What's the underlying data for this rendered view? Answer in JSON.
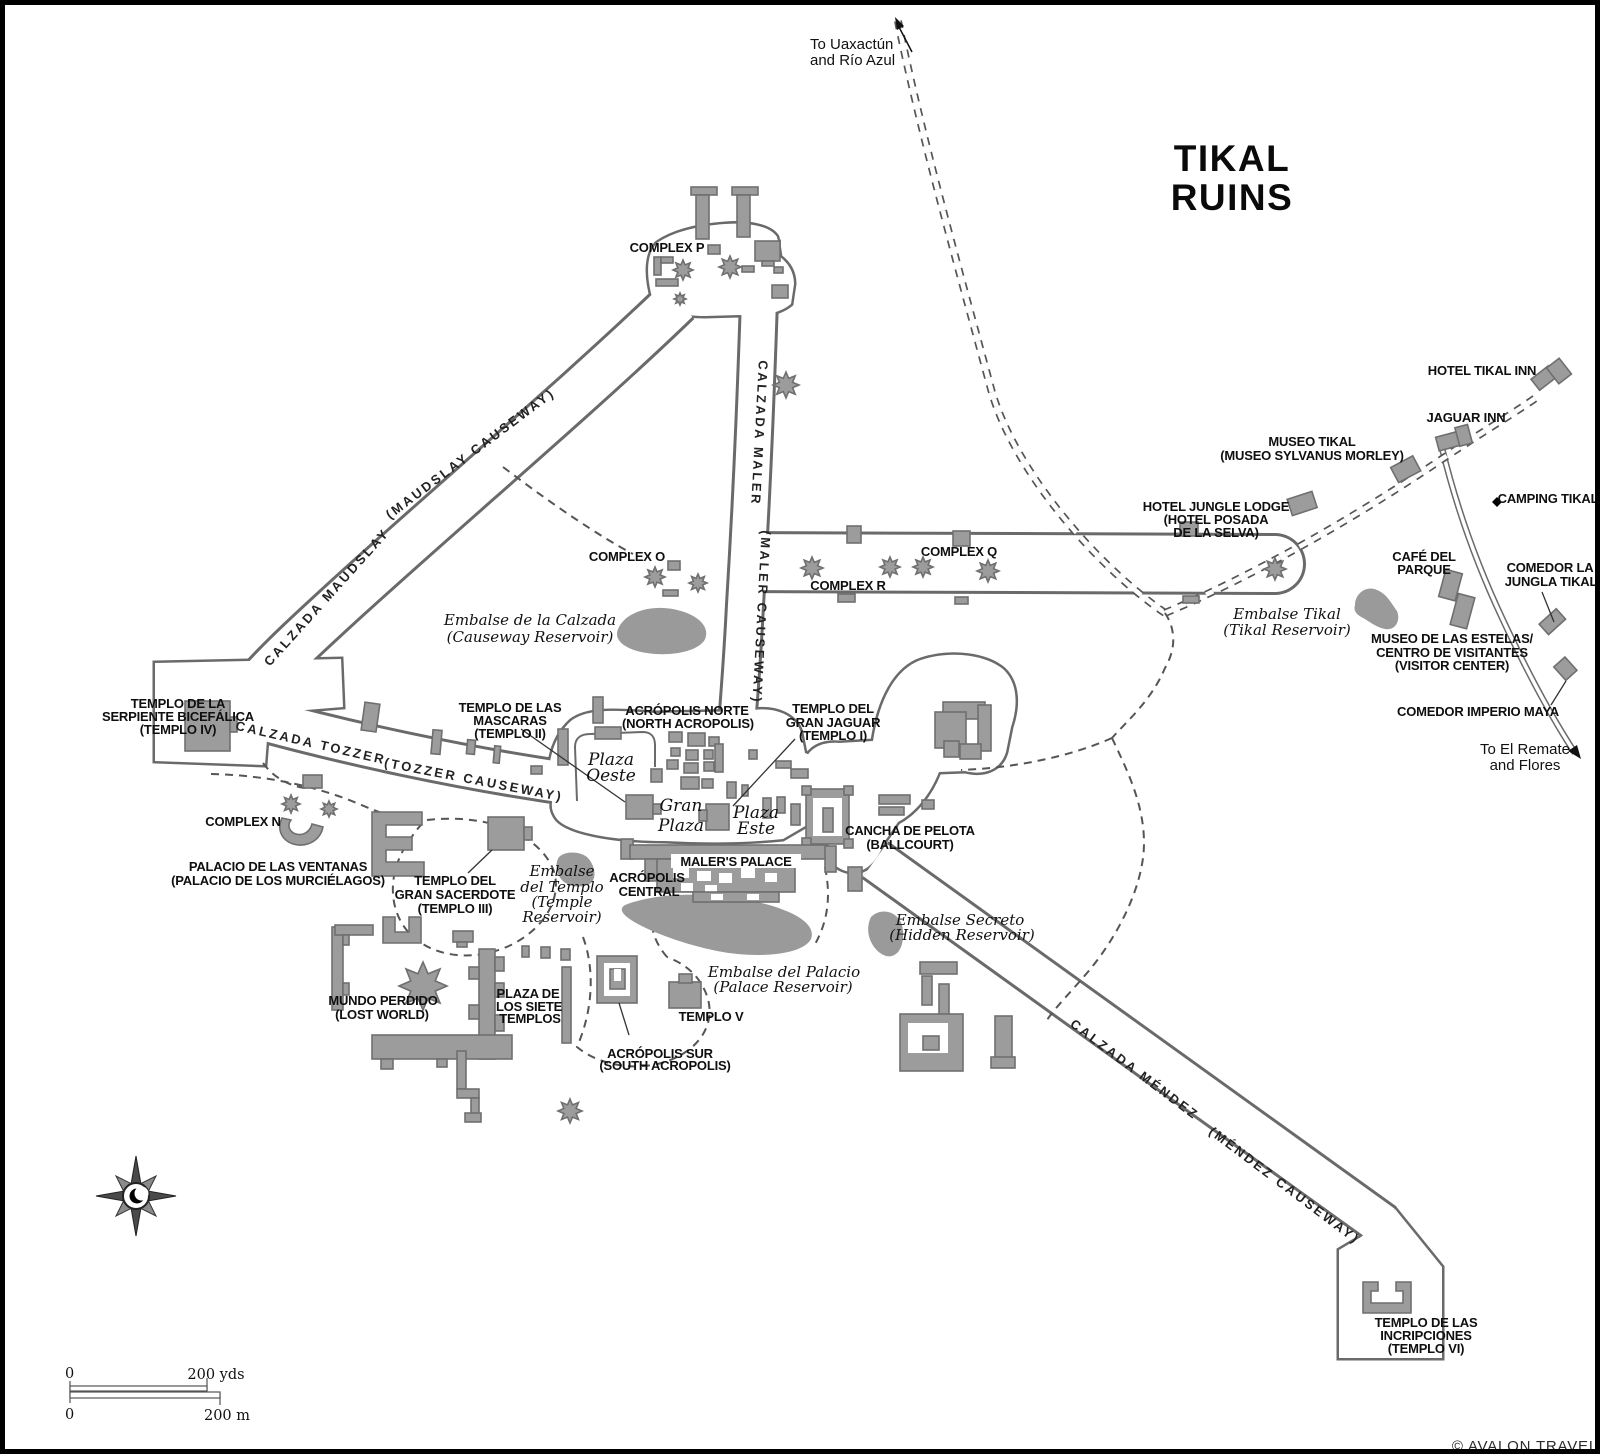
{
  "map": {
    "title_lines": [
      "TIKAL",
      "RUINS"
    ],
    "credit": "© AVALON TRAVEL"
  },
  "directions": {
    "uaxactun": [
      "To Uaxactún",
      "and Río Azul"
    ],
    "el_remate": [
      "To El Remate",
      "and Flores"
    ]
  },
  "causeways": {
    "maudslay": [
      "CALZADA MAUDSLAY",
      "(MAUDSLAY CAUSEWAY)"
    ],
    "maler": [
      "CALZADA MALER",
      "(MALER CAUSEWAY)"
    ],
    "tozzer": [
      "CALZADA TOZZER",
      "(TOZZER CAUSEWAY)"
    ],
    "mendez": [
      "CALZADA MÉNDEZ",
      "(MÉNDEZ CAUSEWAY)"
    ]
  },
  "complexes": {
    "p": "COMPLEX P",
    "o": "COMPLEX O",
    "q": "COMPLEX Q",
    "r": "COMPLEX R",
    "n": "COMPLEX N"
  },
  "monuments": {
    "templo1": [
      "TEMPLO DEL",
      "GRAN JAGUAR",
      "(TEMPLO I)"
    ],
    "templo2": [
      "TEMPLO DE LAS",
      "MASCARAS",
      "(TEMPLO II)"
    ],
    "templo3": [
      "TEMPLO DEL",
      "GRAN SACERDOTE",
      "(TEMPLO III)"
    ],
    "templo4": [
      "TEMPLO DE LA",
      "SERPIENTE BICEFÁLICA",
      "(TEMPLO IV)"
    ],
    "templo5": "TEMPLO V",
    "templo6": [
      "TEMPLO DE LAS",
      "INCRIPCIONES",
      "(TEMPLO VI)"
    ],
    "acropolis_norte": [
      "ACRÓPOLIS NORTE",
      "(NORTH ACROPOLIS)"
    ],
    "acropolis_central": [
      "ACRÓPOLIS",
      "CENTRAL"
    ],
    "acropolis_sur": [
      "ACRÓPOLIS SUR",
      "(SOUTH ACROPOLIS)"
    ],
    "maler_palace": "MALER'S PALACE",
    "cancha": [
      "CANCHA DE PELOTA",
      "(BALLCOURT)"
    ],
    "mundo_perdido": [
      "MUNDO PERDIDO",
      "(LOST WORLD)"
    ],
    "siete_templos": [
      "PLAZA DE",
      "LOS SIETE",
      "TEMPLOS"
    ],
    "palacio_ventanas": [
      "PALACIO DE LAS VENTANAS",
      "(PALACIO DE LOS MURCIÉLAGOS)"
    ]
  },
  "plazas": {
    "oeste": [
      "Plaza",
      "Oeste"
    ],
    "gran": [
      "Gran",
      "Plaza"
    ],
    "este": [
      "Plaza",
      "Este"
    ]
  },
  "reservoirs": {
    "calzada": [
      "Embalse de la Calzada",
      "(Causeway Reservoir)"
    ],
    "tikal": [
      "Embalse Tikal",
      "(Tikal Reservoir)"
    ],
    "templo": [
      "Embalse",
      "del Templo",
      "(Temple",
      "Reservoir)"
    ],
    "secreto": [
      "Embalse Secreto",
      "(Hidden Reservoir)"
    ],
    "palacio": [
      "Embalse del Palacio",
      "(Palace Reservoir)"
    ]
  },
  "amenities": {
    "hotel_tikal_inn": "HOTEL TIKAL INN",
    "jaguar_inn": "JAGUAR INN",
    "museo_tikal": [
      "MUSEO TIKAL",
      "(MUSEO SYLVANUS MORLEY)"
    ],
    "jungle_lodge": [
      "HOTEL JUNGLE LODGE",
      "(HOTEL POSADA",
      "DE LA SELVA)"
    ],
    "camping": "CAMPING TIKAL",
    "cafe_parque": [
      "CAFÉ DEL",
      "PARQUE"
    ],
    "comedor_jungla": [
      "COMEDOR LA",
      "JUNGLA TIKAL"
    ],
    "museo_estelas": [
      "MUSEO DE LAS ESTELAS/",
      "CENTRO DE VISITANTES",
      "(VISITOR CENTER)"
    ],
    "comedor_imperio": "COMEDOR IMPERIO MAYA"
  },
  "scale": {
    "zero_top": "0",
    "yds": "200 yds",
    "zero_bottom": "0",
    "meters": "200 m"
  },
  "colors": {
    "building": "#9c9c9c",
    "building_outline": "#6f6f6f",
    "road_outline": "#6a6a6a",
    "water": "#9a9a9a",
    "ink": "#0f0f0f"
  }
}
